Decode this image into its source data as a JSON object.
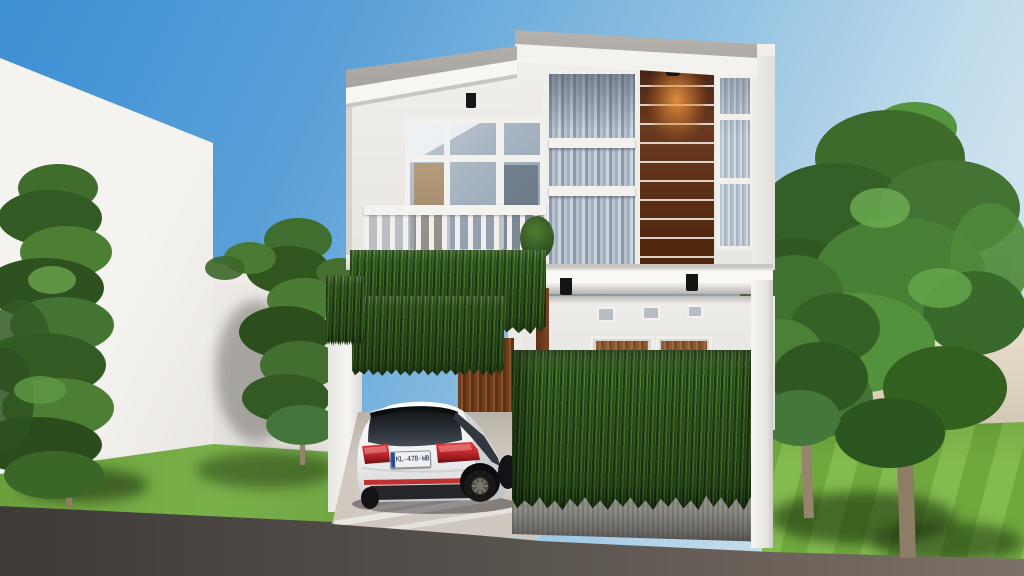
{
  "scene": {
    "description": "3D exterior rendering of a modern two-story white house with wood accent panel, vertical garden vines, a white hatchback parked in the carport, lawns, trees and a hazy city skyline"
  },
  "car": {
    "license_plate": "KL-478-WB",
    "body_color": "#f2f2f4"
  },
  "colors": {
    "sky_top": "#3d8fd4",
    "sky_mid": "#8fc0e2",
    "sky_horizon": "#dcebf3",
    "wall_white": "#f2f0ed",
    "house_white": "#eceae7",
    "soffit_white": "#f8f6f3",
    "parapet_gray": "#aaa6a2",
    "glass_blue": "#9aa9ba",
    "curtain_light": "#c6cfd9",
    "panel_brown": "#6b3a20",
    "panel_brown_dark": "#462414",
    "glow_orange": "#c97a36",
    "wood_door": "#7c4a28",
    "wood_interior": "#b39b7b",
    "vine_dark": "#1e3a17",
    "vine_mid": "#35611f",
    "vine_light": "#4d8129",
    "lawn_green": "#6fa93e",
    "lawn_light": "#82bb4e",
    "planter_gray": "#8d8b86",
    "road_dark": "#3e3a38",
    "road_light": "#6e645c",
    "driveway": "#d2cbc3",
    "city_haze": "#aab7c5",
    "path_tan": "#ddd2bf",
    "taillight_red": "#c1272d",
    "trunk_brown": "#8d7c66"
  }
}
